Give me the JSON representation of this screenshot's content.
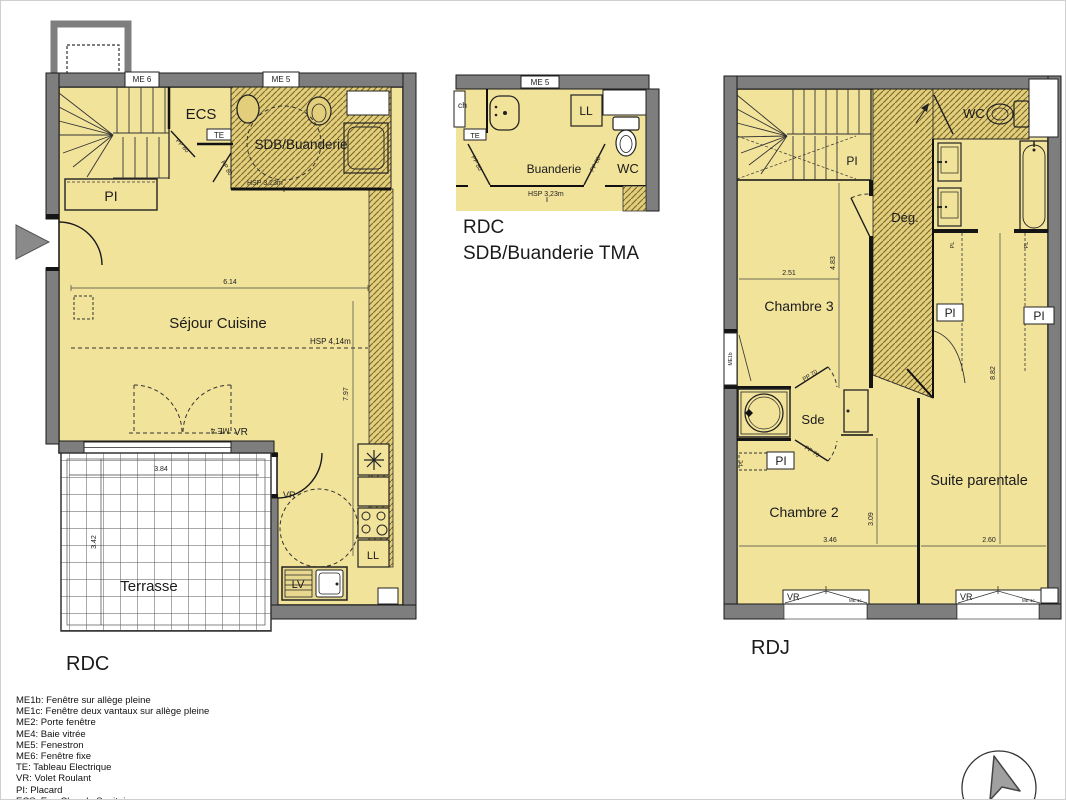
{
  "colors": {
    "floor": "#F2E39B",
    "hatch_base": "#E3CE7C",
    "hatch_line": "#77682B",
    "wall": "#7E7E7E",
    "line": "#1a1a1a"
  },
  "plan_rdc": {
    "title": "RDC",
    "room_sejour": "Séjour Cuisine",
    "room_sdb": "SDB/Buanderie",
    "room_ecs": "ECS",
    "room_pi": "PI",
    "room_terrasse": "Terrasse",
    "label_me6": "ME 6",
    "label_me5": "ME 5",
    "label_te": "TE",
    "label_me4": "ME 4",
    "label_vr_bay": "VR",
    "label_vr_kitchen": "VR",
    "label_ll": "LL",
    "label_lv": "LV",
    "label_pp80_ecs": "PP 80",
    "label_pp80_sdb": "PP 80",
    "dim_width": "6.14",
    "dim_height": "7.97",
    "dim_terrasse_w": "3.84",
    "dim_terrasse_h": "3.42",
    "hsp_sdb": "HSP 3,23m",
    "hsp_sejour": "HSP 4,14m"
  },
  "plan_tma": {
    "title_floor": "RDC",
    "title_name": "SDB/Buanderie TMA",
    "room_buanderie": "Buanderie",
    "room_wc": "WC",
    "label_me5": "ME 5",
    "label_ll": "LL",
    "label_te": "TE",
    "label_ch": "ch",
    "label_pp80_left": "PP 80",
    "label_pp80_right": "PP 80",
    "hsp": "HSP 3,23m"
  },
  "plan_rdj": {
    "title": "RDJ",
    "room_wc": "WC",
    "room_deg": "Dég.",
    "room_chambre3": "Chambre 3",
    "room_sde": "Sde",
    "room_chambre2": "Chambre 2",
    "room_suite": "Suite parentale",
    "label_pi_stair": "PI",
    "label_pi_sde": "PI",
    "label_pl_sde": "PL",
    "label_pl_bath1": "PL",
    "label_pl_bath2": "PL",
    "label_placard1": "Pl",
    "label_placard2": "PI",
    "label_me1b": "ME1b",
    "label_vr1": "VR",
    "label_vr2": "VR",
    "label_me1c1": "ME 1c",
    "label_me1c2": "ME 1c",
    "label_pp70_top": "PP 70",
    "label_pp70_bottom": "PP 70",
    "dim_c3_w": "2.51",
    "dim_c3_h": "4.83",
    "dim_suite_h": "8.82",
    "dim_c2_w": "3.46",
    "dim_c2_h": "3.09",
    "dim_suite_w": "2.60"
  },
  "legend": {
    "items": [
      "ME1b: Fenêtre sur allège pleine",
      "ME1c: Fenêtre deux vantaux sur allège pleine",
      "ME2: Porte fenêtre",
      "ME4: Baie vitrée",
      "ME5: Fenestron",
      "ME6: Fenêtre fixe",
      "TE: Tableau Electrique",
      "VR: Volet Roulant",
      "PI: Placard",
      "ECS: Eau Chaude Sanitaire"
    ]
  }
}
